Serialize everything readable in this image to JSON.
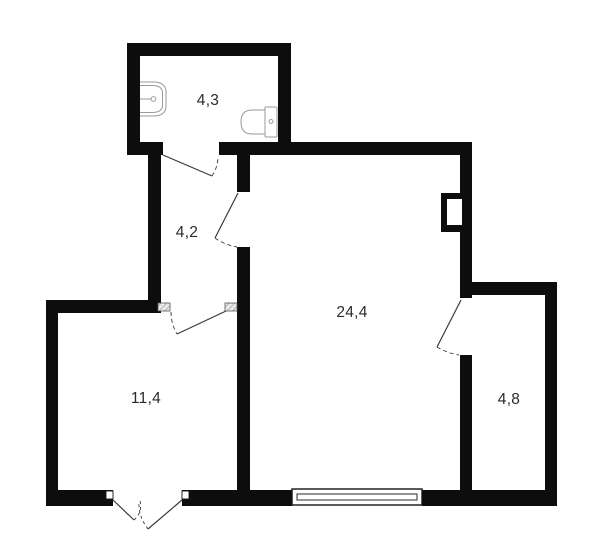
{
  "plan": {
    "rooms": [
      {
        "id": "bathroom",
        "area_label": "4,3"
      },
      {
        "id": "hallway",
        "area_label": "4,2"
      },
      {
        "id": "main-room",
        "area_label": "24,4"
      },
      {
        "id": "room",
        "area_label": "11,4"
      },
      {
        "id": "balcony",
        "area_label": "4,8"
      }
    ],
    "fixtures": [
      {
        "name": "sink-icon"
      },
      {
        "name": "toilet-icon"
      }
    ],
    "symbols": [
      {
        "name": "window-icon"
      },
      {
        "name": "door-swing"
      },
      {
        "name": "door-threshold-hatch"
      },
      {
        "name": "wall-niche"
      }
    ],
    "colors": {
      "wall": "#0d0d0d",
      "door_line": "#3a3a3a",
      "fixture_line": "#9a9a9a",
      "label": "#2a2a2a",
      "hatch_fill": "#e9e9e9",
      "background": "#ffffff"
    }
  }
}
